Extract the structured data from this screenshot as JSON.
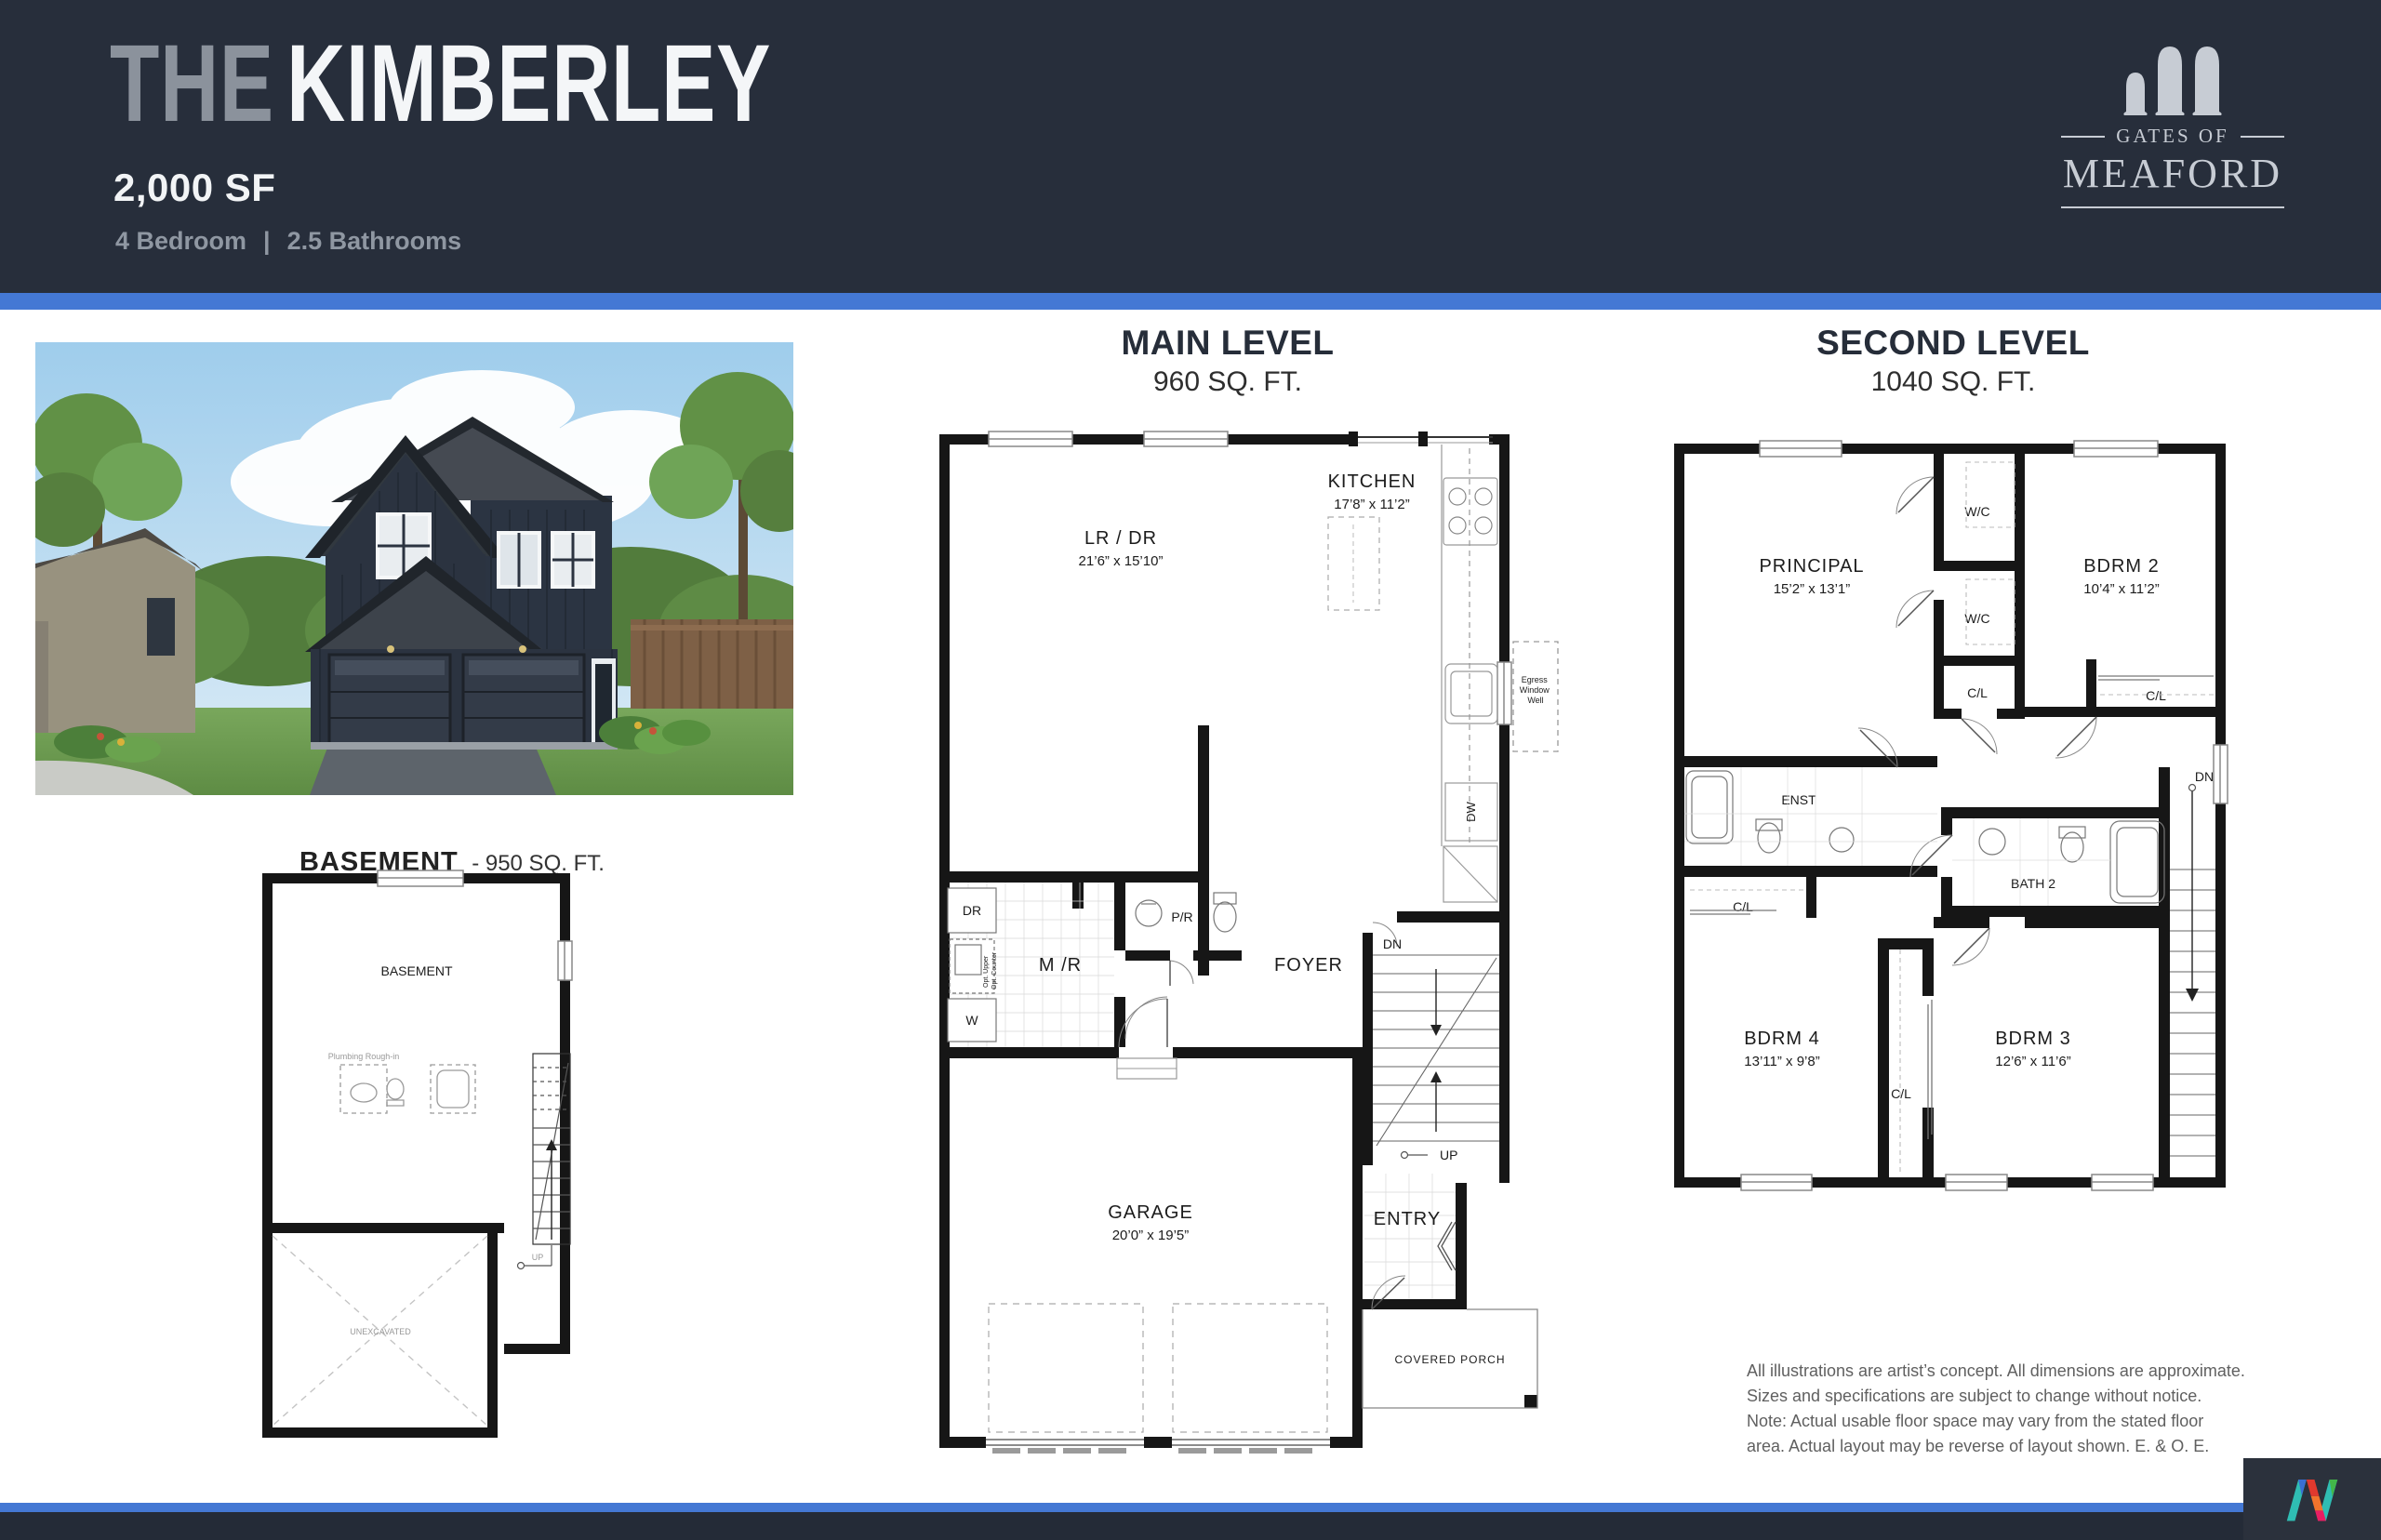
{
  "header": {
    "title_prefix": "THE",
    "title_name": "KIMBERLEY",
    "sqft": "2,000 SF",
    "bedrooms": "4 Bedroom",
    "separator": "|",
    "bathrooms": "2.5 Bathrooms"
  },
  "brand": {
    "gates_of": "GATES OF",
    "name": "MEAFORD"
  },
  "colors": {
    "header_bg": "#272e3b",
    "accent_blue": "#4478d4",
    "footer_bg": "#242b37",
    "wall": "#161616"
  },
  "plans": {
    "basement": {
      "title": "BASEMENT",
      "title_suffix": "- 950 SQ. FT.",
      "room_label": "BASEMENT",
      "unexcavated": "UNEXCAVATED",
      "plumbing": "Plumbing Rough-in",
      "up": "UP"
    },
    "main": {
      "title": "MAIN LEVEL",
      "sqft": "960 SQ. FT.",
      "kitchen": "KITCHEN",
      "kitchen_dims": "17’8” x 11’2”",
      "lrdr": "LR / DR",
      "lrdr_dims": "21’6” x 15’10”",
      "mr": "M /R",
      "pr": "P/R",
      "foyer": "FOYER",
      "garage": "GARAGE",
      "garage_dims": "20’0” x 19’5”",
      "entry": "ENTRY",
      "porch": "COVERED PORCH",
      "dr": "DR",
      "w": "W",
      "dw": "DW",
      "dn": "DN",
      "up": "UP",
      "opt_upper": "Opt. Upper",
      "opt_counter": "Opt. Counter",
      "egress": [
        "Egress",
        "Window",
        "Well"
      ]
    },
    "second": {
      "title": "SECOND LEVEL",
      "sqft": "1040 SQ. FT.",
      "principal": "PRINCIPAL",
      "principal_dims": "15’2” x 13’1”",
      "bdrm2": "BDRM 2",
      "bdrm2_dims": "10’4” x 11’2”",
      "bdrm3": "BDRM 3",
      "bdrm3_dims": "12’6” x 11’6”",
      "bdrm4": "BDRM 4",
      "bdrm4_dims": "13’11” x 9’8”",
      "wc1": "W/C",
      "wc2": "W/C",
      "cl1": "C/L",
      "cl2": "C/L",
      "cl3": "C/L",
      "cl4": "C/L",
      "enst": "ENST",
      "bath2": "BATH 2",
      "dn": "DN"
    }
  },
  "disclaimer": {
    "line1": "All illustrations are artist’s concept. All dimensions are approximate.",
    "line2": "Sizes and specifications are subject to change without notice.",
    "line3": "Note: Actual usable floor space may vary from the stated floor",
    "line4": "area. Actual layout may be reverse of layout shown. E. & O. E."
  }
}
